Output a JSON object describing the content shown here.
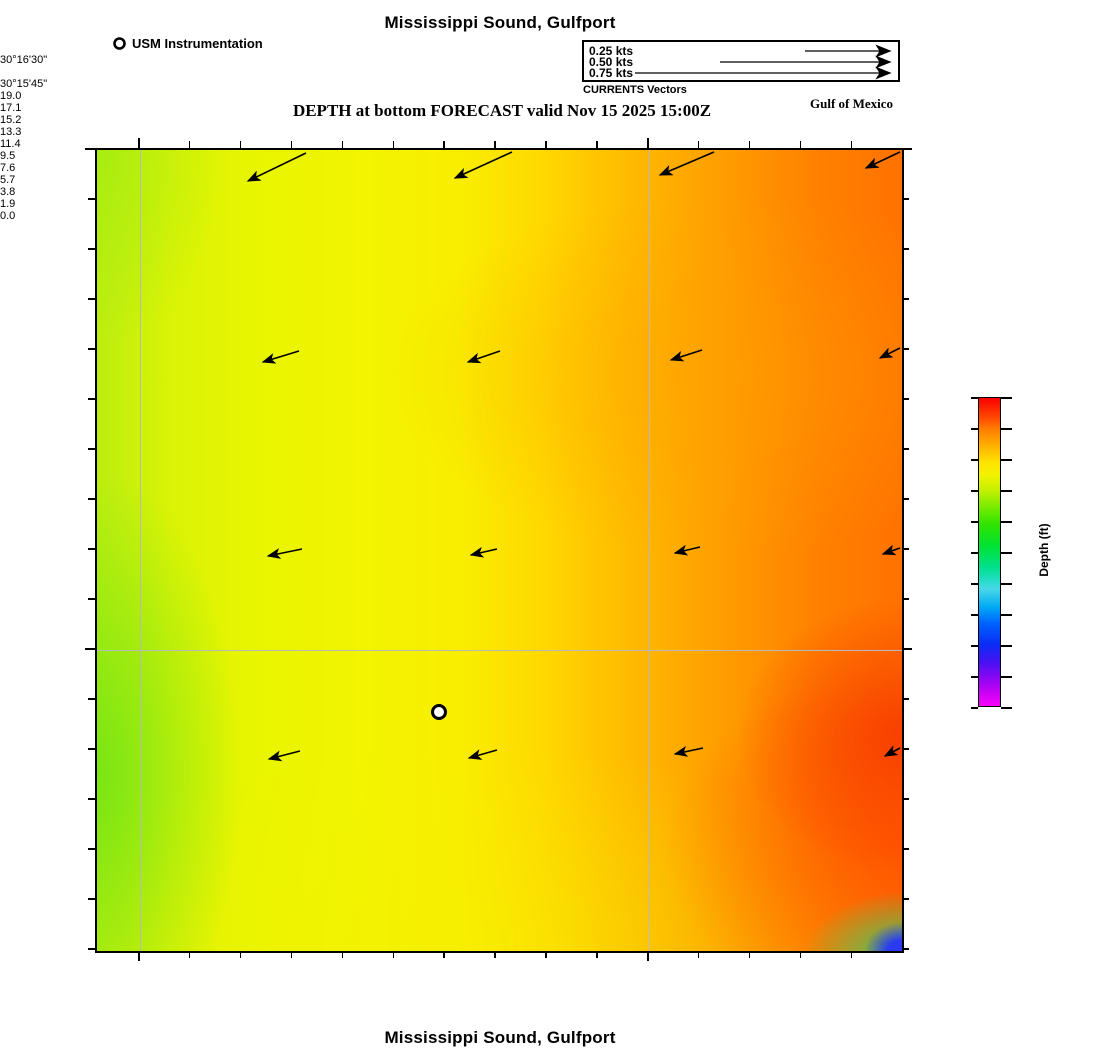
{
  "header": {
    "title": "Mississippi Sound, Gulfport",
    "subtitle": "DEPTH at bottom FORECAST valid Nov 15 2025 15:00Z",
    "instrument_legend_label": "USM Instrumentation",
    "region_label": "Gulf of Mexico",
    "vector_legend": {
      "caption": "CURRENTS Vectors",
      "items": [
        {
          "label": "0.25 kts",
          "length": 85
        },
        {
          "label": "0.50 kts",
          "length": 170
        },
        {
          "label": "0.75 kts",
          "length": 255
        }
      ]
    }
  },
  "footer": {
    "title": "Mississippi Sound, Gulfport"
  },
  "axes": {
    "lon_ticks": [
      {
        "label": "−89°05'15\"",
        "x": 138
      },
      {
        "label": "−89°04'30\"",
        "x": 647
      }
    ],
    "lat_ticks": [
      {
        "label": "30°16'30\"",
        "y": 148
      },
      {
        "label": "30°15'45\"",
        "y": 648
      }
    ]
  },
  "colorbar": {
    "label": "Depth (ft)",
    "ticks": [
      "19.0",
      "17.1",
      "15.2",
      "13.3",
      "11.4",
      "9.5",
      "7.6",
      "5.7",
      "3.8",
      "1.9",
      "0.0"
    ]
  },
  "chart_data": {
    "type": "heatmap",
    "title": "Mississippi Sound, Gulfport",
    "subtitle": "DEPTH at bottom FORECAST valid Nov 15 2025 15:00Z",
    "valid_time": "Nov 15 2025 15:00Z",
    "variable": "Depth (ft)",
    "colorbar_range": [
      0.0,
      19.0
    ],
    "colorbar_ticks": [
      19.0,
      17.1,
      15.2,
      13.3,
      11.4,
      9.5,
      7.6,
      5.7,
      3.8,
      1.9,
      0.0
    ],
    "x_axis": {
      "ticks": [
        "−89°05'15\"",
        "−89°04'30\""
      ],
      "units": "longitude"
    },
    "y_axis": {
      "ticks": [
        "30°16'30\"",
        "30°15'45\""
      ],
      "units": "latitude"
    },
    "field_summary": {
      "west_depth_ft": 14.0,
      "center_depth_ft": 15.5,
      "east_depth_ft": 17.8,
      "southeast_corner_depth_ft": 4.5,
      "description": "Depth shades from yellow-green (~13.5-14.5 ft) in the west through yellow (~15-16 ft) mid-basin to orange-red (~17-18.5 ft) in the east; a shallow green-to-blue pocket (~11 down to ~4 ft) sits in the extreme southeast corner."
    },
    "current_vectors": {
      "direction": "westward to west-southwest",
      "approx_speed_kts": 0.15,
      "arrows": [
        [
          209,
          3,
          151,
          31
        ],
        [
          415,
          2,
          358,
          28
        ],
        [
          617,
          2,
          563,
          25
        ],
        [
          803,
          2,
          769,
          18
        ],
        [
          202,
          201,
          166,
          212
        ],
        [
          403,
          201,
          371,
          212
        ],
        [
          605,
          200,
          574,
          210
        ],
        [
          803,
          198,
          783,
          208
        ],
        [
          205,
          399,
          171,
          406
        ],
        [
          400,
          399,
          374,
          405
        ],
        [
          603,
          397,
          578,
          403
        ],
        [
          803,
          398,
          786,
          404
        ],
        [
          203,
          601,
          172,
          609
        ],
        [
          400,
          600,
          372,
          608
        ],
        [
          606,
          598,
          578,
          604
        ],
        [
          803,
          598,
          788,
          606
        ]
      ]
    },
    "station_marker": {
      "x": 342,
      "y": 562,
      "label": "USM Instrumentation"
    }
  }
}
